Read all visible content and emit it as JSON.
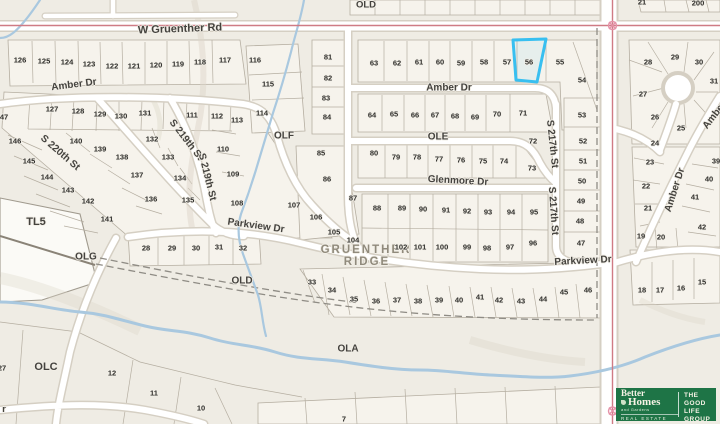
{
  "colors": {
    "map_bg": "#efece4",
    "block_fill": "#f6f3ec",
    "road_fill": "#ffffff",
    "road_casing": "#d5cfc3",
    "lot_line": "#b5aea1",
    "stream": "#a9c8df",
    "boundary": "#cf7b85",
    "highlight": "#38bff0",
    "label": "#44423e",
    "lot_label": "#2e2d2a",
    "place_label": "#908a7c",
    "logo_green": "#1e7446"
  },
  "map": {
    "highlight": {
      "lot": "56"
    },
    "street_labels": [
      {
        "text": "W Gruenther Rd",
        "x": 180,
        "y": 29,
        "rot": -2,
        "size": 11
      },
      {
        "text": "Amber Dr",
        "x": 74,
        "y": 85,
        "rot": -7
      },
      {
        "text": "Amber Dr",
        "x": 449,
        "y": 88,
        "rot": 0
      },
      {
        "text": "Glenmore Dr",
        "x": 458,
        "y": 181,
        "rot": 3
      },
      {
        "text": "Parkview Dr",
        "x": 256,
        "y": 226,
        "rot": 8
      },
      {
        "text": "Parkview Dr",
        "x": 583,
        "y": 261,
        "rot": -3
      },
      {
        "text": "S 220th St",
        "x": 60,
        "y": 153,
        "rot": 41
      },
      {
        "text": "S 219th St",
        "x": 186,
        "y": 140,
        "rot": 52
      },
      {
        "text": "S 219th St",
        "x": 207,
        "y": 177,
        "rot": 76
      },
      {
        "text": "S 217th St",
        "x": 552,
        "y": 144,
        "rot": 84
      },
      {
        "text": "S 217th St",
        "x": 553,
        "y": 211,
        "rot": 86
      },
      {
        "text": "Amber Dr",
        "x": 675,
        "y": 190,
        "rot": -72
      },
      {
        "text": "Amber Dr",
        "x": 719,
        "y": 110,
        "rot": -52
      },
      {
        "text": "r",
        "x": 4,
        "y": 409,
        "rot": 0,
        "size": 9
      }
    ],
    "area_labels": [
      {
        "text": "OLD",
        "x": 366,
        "y": 5
      },
      {
        "text": "OLF",
        "x": 284,
        "y": 136,
        "size": 10
      },
      {
        "text": "OLE",
        "x": 438,
        "y": 137,
        "size": 10
      },
      {
        "text": "OLD",
        "x": 242,
        "y": 281,
        "size": 10
      },
      {
        "text": "OLG",
        "x": 86,
        "y": 257,
        "size": 10
      },
      {
        "text": "OLA",
        "x": 348,
        "y": 349,
        "size": 10
      },
      {
        "text": "OLC",
        "x": 46,
        "y": 367,
        "size": 11
      },
      {
        "text": "TL5",
        "x": 36,
        "y": 222,
        "size": 11
      },
      {
        "text": "GRUENTHER",
        "x": 366,
        "y": 250,
        "size": 11.5,
        "cls": "place"
      },
      {
        "text": "RIDGE",
        "x": 367,
        "y": 262,
        "size": 11.5,
        "cls": "place"
      }
    ],
    "lots": [
      {
        "n": "126",
        "x": 20,
        "y": 60
      },
      {
        "n": "125",
        "x": 44,
        "y": 61
      },
      {
        "n": "124",
        "x": 67,
        "y": 62
      },
      {
        "n": "123",
        "x": 89,
        "y": 64
      },
      {
        "n": "122",
        "x": 112,
        "y": 66
      },
      {
        "n": "121",
        "x": 134,
        "y": 66
      },
      {
        "n": "120",
        "x": 156,
        "y": 65
      },
      {
        "n": "119",
        "x": 178,
        "y": 64
      },
      {
        "n": "118",
        "x": 200,
        "y": 62
      },
      {
        "n": "117",
        "x": 225,
        "y": 60
      },
      {
        "n": "116",
        "x": 255,
        "y": 60
      },
      {
        "n": "115",
        "x": 268,
        "y": 84
      },
      {
        "n": "114",
        "x": 262,
        "y": 113
      },
      {
        "n": "113",
        "x": 237,
        "y": 120
      },
      {
        "n": "81",
        "x": 328,
        "y": 57
      },
      {
        "n": "82",
        "x": 328,
        "y": 78
      },
      {
        "n": "83",
        "x": 326,
        "y": 98
      },
      {
        "n": "84",
        "x": 327,
        "y": 117
      },
      {
        "n": "63",
        "x": 374,
        "y": 63
      },
      {
        "n": "62",
        "x": 397,
        "y": 63
      },
      {
        "n": "61",
        "x": 419,
        "y": 62
      },
      {
        "n": "60",
        "x": 440,
        "y": 62
      },
      {
        "n": "59",
        "x": 461,
        "y": 63
      },
      {
        "n": "58",
        "x": 484,
        "y": 62
      },
      {
        "n": "57",
        "x": 507,
        "y": 62
      },
      {
        "n": "56",
        "x": 529,
        "y": 62
      },
      {
        "n": "55",
        "x": 560,
        "y": 62
      },
      {
        "n": "54",
        "x": 582,
        "y": 80
      },
      {
        "n": "53",
        "x": 582,
        "y": 115
      },
      {
        "n": "64",
        "x": 372,
        "y": 115
      },
      {
        "n": "65",
        "x": 394,
        "y": 114
      },
      {
        "n": "66",
        "x": 415,
        "y": 115
      },
      {
        "n": "67",
        "x": 435,
        "y": 115
      },
      {
        "n": "68",
        "x": 455,
        "y": 116
      },
      {
        "n": "69",
        "x": 475,
        "y": 117
      },
      {
        "n": "70",
        "x": 497,
        "y": 114
      },
      {
        "n": "71",
        "x": 523,
        "y": 113
      },
      {
        "n": "72",
        "x": 533,
        "y": 141
      },
      {
        "n": "73",
        "x": 532,
        "y": 168
      },
      {
        "n": "74",
        "x": 504,
        "y": 161
      },
      {
        "n": "75",
        "x": 483,
        "y": 161
      },
      {
        "n": "80",
        "x": 374,
        "y": 153
      },
      {
        "n": "79",
        "x": 396,
        "y": 157
      },
      {
        "n": "78",
        "x": 417,
        "y": 157
      },
      {
        "n": "77",
        "x": 439,
        "y": 159
      },
      {
        "n": "76",
        "x": 461,
        "y": 160
      },
      {
        "n": "85",
        "x": 321,
        "y": 153
      },
      {
        "n": "86",
        "x": 327,
        "y": 179
      },
      {
        "n": "87",
        "x": 353,
        "y": 198
      },
      {
        "n": "88",
        "x": 377,
        "y": 208
      },
      {
        "n": "89",
        "x": 402,
        "y": 208
      },
      {
        "n": "90",
        "x": 423,
        "y": 209
      },
      {
        "n": "91",
        "x": 446,
        "y": 210
      },
      {
        "n": "92",
        "x": 467,
        "y": 211
      },
      {
        "n": "93",
        "x": 488,
        "y": 212
      },
      {
        "n": "94",
        "x": 511,
        "y": 212
      },
      {
        "n": "95",
        "x": 534,
        "y": 212
      },
      {
        "n": "102",
        "x": 401,
        "y": 247
      },
      {
        "n": "101",
        "x": 420,
        "y": 247
      },
      {
        "n": "100",
        "x": 442,
        "y": 247
      },
      {
        "n": "99",
        "x": 467,
        "y": 247
      },
      {
        "n": "98",
        "x": 487,
        "y": 248
      },
      {
        "n": "97",
        "x": 510,
        "y": 247
      },
      {
        "n": "96",
        "x": 533,
        "y": 243
      },
      {
        "n": "52",
        "x": 583,
        "y": 141
      },
      {
        "n": "51",
        "x": 583,
        "y": 161
      },
      {
        "n": "50",
        "x": 582,
        "y": 181
      },
      {
        "n": "49",
        "x": 581,
        "y": 201
      },
      {
        "n": "48",
        "x": 580,
        "y": 221
      },
      {
        "n": "47",
        "x": 581,
        "y": 243
      },
      {
        "n": "127",
        "x": 52,
        "y": 109
      },
      {
        "n": "128",
        "x": 78,
        "y": 111
      },
      {
        "n": "129",
        "x": 100,
        "y": 114
      },
      {
        "n": "130",
        "x": 121,
        "y": 116
      },
      {
        "n": "131",
        "x": 145,
        "y": 113
      },
      {
        "n": "111",
        "x": 192,
        "y": 115
      },
      {
        "n": "112",
        "x": 217,
        "y": 116
      },
      {
        "n": "110",
        "x": 223,
        "y": 149
      },
      {
        "n": "109",
        "x": 233,
        "y": 174
      },
      {
        "n": "108",
        "x": 237,
        "y": 203
      },
      {
        "n": "132",
        "x": 152,
        "y": 139
      },
      {
        "n": "133",
        "x": 168,
        "y": 157
      },
      {
        "n": "134",
        "x": 180,
        "y": 178
      },
      {
        "n": "135",
        "x": 188,
        "y": 200
      },
      {
        "n": "136",
        "x": 151,
        "y": 199
      },
      {
        "n": "137",
        "x": 137,
        "y": 175
      },
      {
        "n": "138",
        "x": 122,
        "y": 157
      },
      {
        "n": "139",
        "x": 100,
        "y": 149
      },
      {
        "n": "140",
        "x": 76,
        "y": 141
      },
      {
        "n": "141",
        "x": 107,
        "y": 219
      },
      {
        "n": "142",
        "x": 88,
        "y": 201
      },
      {
        "n": "143",
        "x": 68,
        "y": 190
      },
      {
        "n": "144",
        "x": 47,
        "y": 177
      },
      {
        "n": "145",
        "x": 29,
        "y": 161
      },
      {
        "n": "146",
        "x": 15,
        "y": 141
      },
      {
        "n": "47",
        "x": 4,
        "y": 117
      },
      {
        "n": "28",
        "x": 146,
        "y": 248
      },
      {
        "n": "29",
        "x": 172,
        "y": 248
      },
      {
        "n": "30",
        "x": 196,
        "y": 248
      },
      {
        "n": "31",
        "x": 219,
        "y": 247
      },
      {
        "n": "32",
        "x": 243,
        "y": 248
      },
      {
        "n": "33",
        "x": 312,
        "y": 282
      },
      {
        "n": "34",
        "x": 332,
        "y": 290
      },
      {
        "n": "35",
        "x": 354,
        "y": 299
      },
      {
        "n": "36",
        "x": 376,
        "y": 301
      },
      {
        "n": "37",
        "x": 397,
        "y": 300
      },
      {
        "n": "38",
        "x": 418,
        "y": 301
      },
      {
        "n": "39",
        "x": 439,
        "y": 300
      },
      {
        "n": "40",
        "x": 459,
        "y": 300
      },
      {
        "n": "41",
        "x": 480,
        "y": 297
      },
      {
        "n": "42",
        "x": 499,
        "y": 300
      },
      {
        "n": "43",
        "x": 521,
        "y": 301
      },
      {
        "n": "44",
        "x": 543,
        "y": 299
      },
      {
        "n": "45",
        "x": 564,
        "y": 292
      },
      {
        "n": "46",
        "x": 588,
        "y": 290
      },
      {
        "n": "104",
        "x": 353,
        "y": 240
      },
      {
        "n": "105",
        "x": 334,
        "y": 232
      },
      {
        "n": "106",
        "x": 316,
        "y": 217
      },
      {
        "n": "107",
        "x": 294,
        "y": 205
      },
      {
        "n": "28",
        "x": 648,
        "y": 62
      },
      {
        "n": "29",
        "x": 675,
        "y": 57
      },
      {
        "n": "30",
        "x": 699,
        "y": 62
      },
      {
        "n": "31",
        "x": 714,
        "y": 81
      },
      {
        "n": "27",
        "x": 643,
        "y": 94
      },
      {
        "n": "26",
        "x": 655,
        "y": 117
      },
      {
        "n": "25",
        "x": 681,
        "y": 128
      },
      {
        "n": "24",
        "x": 655,
        "y": 143
      },
      {
        "n": "23",
        "x": 650,
        "y": 162
      },
      {
        "n": "22",
        "x": 646,
        "y": 186
      },
      {
        "n": "21",
        "x": 648,
        "y": 208
      },
      {
        "n": "20",
        "x": 661,
        "y": 237
      },
      {
        "n": "19",
        "x": 641,
        "y": 236
      },
      {
        "n": "39",
        "x": 716,
        "y": 161
      },
      {
        "n": "40",
        "x": 709,
        "y": 179
      },
      {
        "n": "41",
        "x": 695,
        "y": 197
      },
      {
        "n": "42",
        "x": 702,
        "y": 227
      },
      {
        "n": "15",
        "x": 702,
        "y": 282
      },
      {
        "n": "16",
        "x": 681,
        "y": 288
      },
      {
        "n": "17",
        "x": 660,
        "y": 290
      },
      {
        "n": "18",
        "x": 642,
        "y": 290
      },
      {
        "n": "12",
        "x": 112,
        "y": 373
      },
      {
        "n": "11",
        "x": 154,
        "y": 393
      },
      {
        "n": "10",
        "x": 201,
        "y": 408
      },
      {
        "n": "27",
        "x": 2,
        "y": 368
      },
      {
        "n": "7",
        "x": 344,
        "y": 419
      },
      {
        "n": "200",
        "x": 698,
        "y": 3
      },
      {
        "n": "21",
        "x": 642,
        "y": 2
      }
    ]
  },
  "logo": {
    "brand_line1": "Better",
    "brand_line2": "Homes",
    "brand_sub": "and Gardens",
    "brand_tag": "REAL ESTATE",
    "group_line1": "THE",
    "group_line2": "GOOD LIFE",
    "group_line3": "GROUP"
  }
}
